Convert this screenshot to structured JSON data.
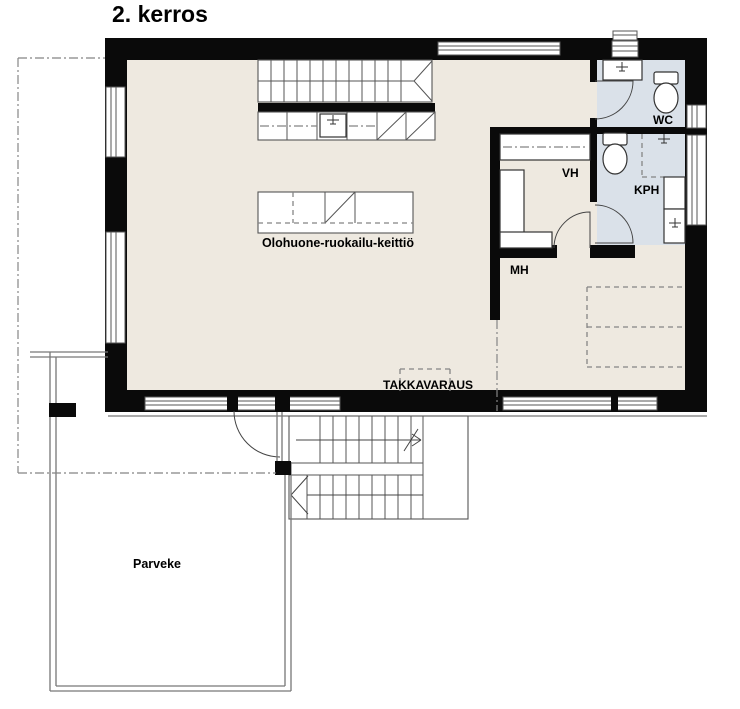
{
  "title": "2. kerros",
  "rooms": {
    "living": {
      "label": "Olohuone-ruokailu-keittiö"
    },
    "wc": {
      "label": "WC"
    },
    "vh": {
      "label": "VH"
    },
    "kph": {
      "label": "KPH"
    },
    "mh": {
      "label": "MH"
    },
    "takka": {
      "label": "TAKKAVARAUS"
    },
    "balcony": {
      "label": "Parveke"
    }
  },
  "colors": {
    "wall": "#0a0a0a",
    "floor": "#EEE9E0",
    "wet": "#DAE1E9",
    "line": "#555555",
    "dash": "#858585"
  }
}
